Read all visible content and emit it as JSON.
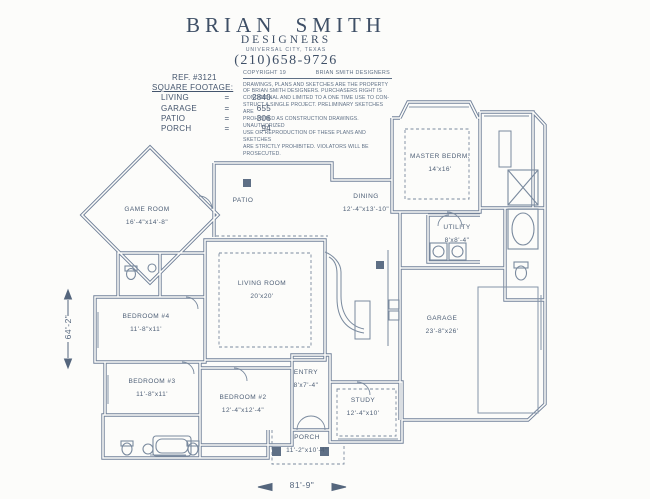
{
  "header": {
    "brand": "BRIAN SMITH",
    "brand_sub": "DESIGNERS",
    "location": "UNIVERSAL CITY, TEXAS",
    "phone": "(210)658-9726"
  },
  "ref_block": {
    "ref": "REF. #3121",
    "title": "SQUARE FOOTAGE:",
    "rows": [
      {
        "label": "LIVING",
        "eq": "=",
        "value": "2840"
      },
      {
        "label": "GARAGE",
        "eq": "=",
        "value": "655"
      },
      {
        "label": "PATIO",
        "eq": "=",
        "value": "306"
      },
      {
        "label": "PORCH",
        "eq": "=",
        "value": "94"
      }
    ]
  },
  "copyright": {
    "line1_left": "COPYRIGHT 19",
    "line1_right": "BRIAN SMITH DESIGNERS",
    "body_lines": [
      "DRAWINGS, PLANS AND SKETCHES ARE THE PROPERTY",
      "OF BRIAN SMITH DESIGNERS.  PURCHASERS RIGHT IS",
      "CONDITIONAL AND LIMITED TO A ONE TIME USE TO CON-",
      "STRUCT A SINGLE PROJECT.  PRELIMINARY SKETCHES ARE",
      "PROHIBITED AS CONSTRUCTION DRAWINGS.  UNAUTHORIZED",
      "USE OR REPRODUCTION OF THESE PLANS AND SKETCHES",
      "ARE STRICTLY PROHIBITED.  VIOLATORS WILL BE PROSECUTED."
    ]
  },
  "rooms": [
    {
      "name": "MASTER BEDRM.",
      "dims": "14'x16'"
    },
    {
      "name": "DINING",
      "dims": "12'-4\"x13'-10\""
    },
    {
      "name": "PATIO",
      "dims": ""
    },
    {
      "name": "GAME ROOM",
      "dims": "16'-4\"x14'-8\""
    },
    {
      "name": "UTILITY",
      "dims": "8'x8'-4\""
    },
    {
      "name": "LIVING ROOM",
      "dims": "20'x20'"
    },
    {
      "name": "BEDROOM #4",
      "dims": "11'-8\"x11'"
    },
    {
      "name": "GARAGE",
      "dims": "23'-8\"x26'"
    },
    {
      "name": "BEDROOM #3",
      "dims": "11'-8\"x11'"
    },
    {
      "name": "ENTRY",
      "dims": "8'x7'-4\""
    },
    {
      "name": "BEDROOM #2",
      "dims": "12'-4\"x12'-4\""
    },
    {
      "name": "STUDY",
      "dims": "12'-4\"x10'"
    },
    {
      "name": "PORCH",
      "dims": "11'-2\"x10'-4\""
    }
  ],
  "dimensions": {
    "overall_width": "81'-9\"",
    "overall_height": "64'-2\""
  },
  "colors": {
    "ink": "#72829a",
    "paper": "#fcfcfa",
    "header_ink": "#3e4f66"
  }
}
